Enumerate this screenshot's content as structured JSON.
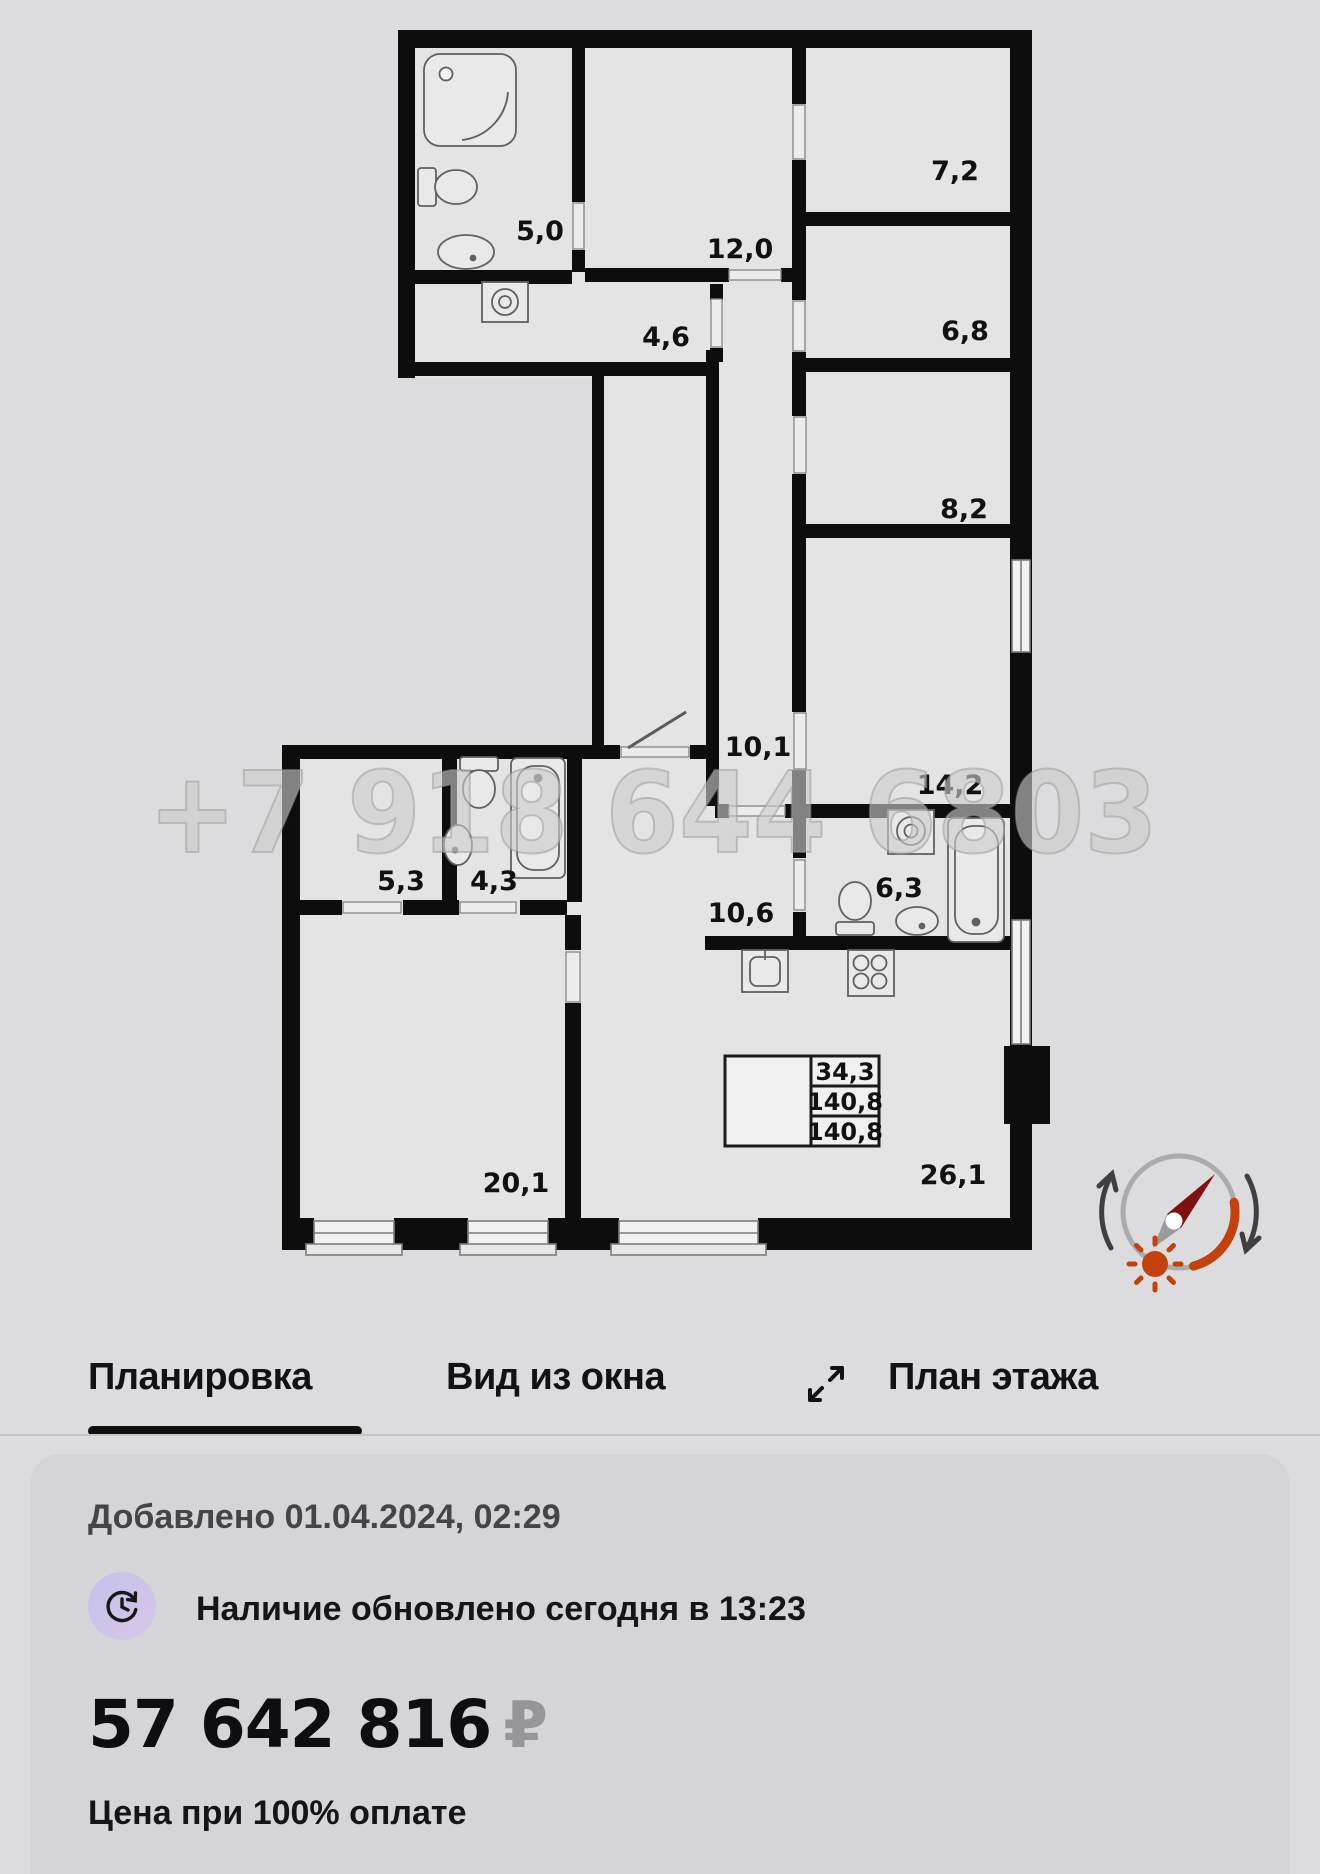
{
  "floor_plan": {
    "watermark": "+7 918 644 6803",
    "rooms": [
      {
        "name": "bathroom-shower",
        "area": "5,0"
      },
      {
        "name": "bedroom-12",
        "area": "12,0"
      },
      {
        "name": "hallway-4-6",
        "area": "4,6"
      },
      {
        "name": "room-7-2",
        "area": "7,2"
      },
      {
        "name": "room-6-8",
        "area": "6,8"
      },
      {
        "name": "room-8-2",
        "area": "8,2"
      },
      {
        "name": "corridor-10-1",
        "area": "10,1"
      },
      {
        "name": "bedroom-14-2",
        "area": "14,2"
      },
      {
        "name": "wardrobe-5-3",
        "area": "5,3"
      },
      {
        "name": "bathroom-4-3",
        "area": "4,3"
      },
      {
        "name": "hall-10-6",
        "area": "10,6"
      },
      {
        "name": "bathroom-6-3",
        "area": "6,3"
      },
      {
        "name": "bedroom-20-1",
        "area": "20,1"
      },
      {
        "name": "kitchen-living-26-1",
        "area": "26,1"
      }
    ],
    "area_table": {
      "values": [
        "34,3",
        "140,8",
        "140,8"
      ]
    }
  },
  "tabs": [
    {
      "label": "Планировка",
      "active": true
    },
    {
      "label": "Вид из окна",
      "active": false
    },
    {
      "label": "План этажа",
      "active": false
    }
  ],
  "details": {
    "added": "Добавлено 01.04.2024, 02:29",
    "availability": "Наличие обновлено сегодня в 13:23",
    "price": {
      "amount": "57 642 816",
      "currency": "₽"
    },
    "price_note": "Цена при 100% оплате"
  },
  "colors": {
    "wall": "#0d0d0d",
    "room_fill": "#e4e4e5",
    "compass_orange": "#c2410c",
    "compass_needle_red": "#7f1010",
    "tab_underline": "#101010",
    "avail_icon_bg": "#c6c2e9"
  }
}
